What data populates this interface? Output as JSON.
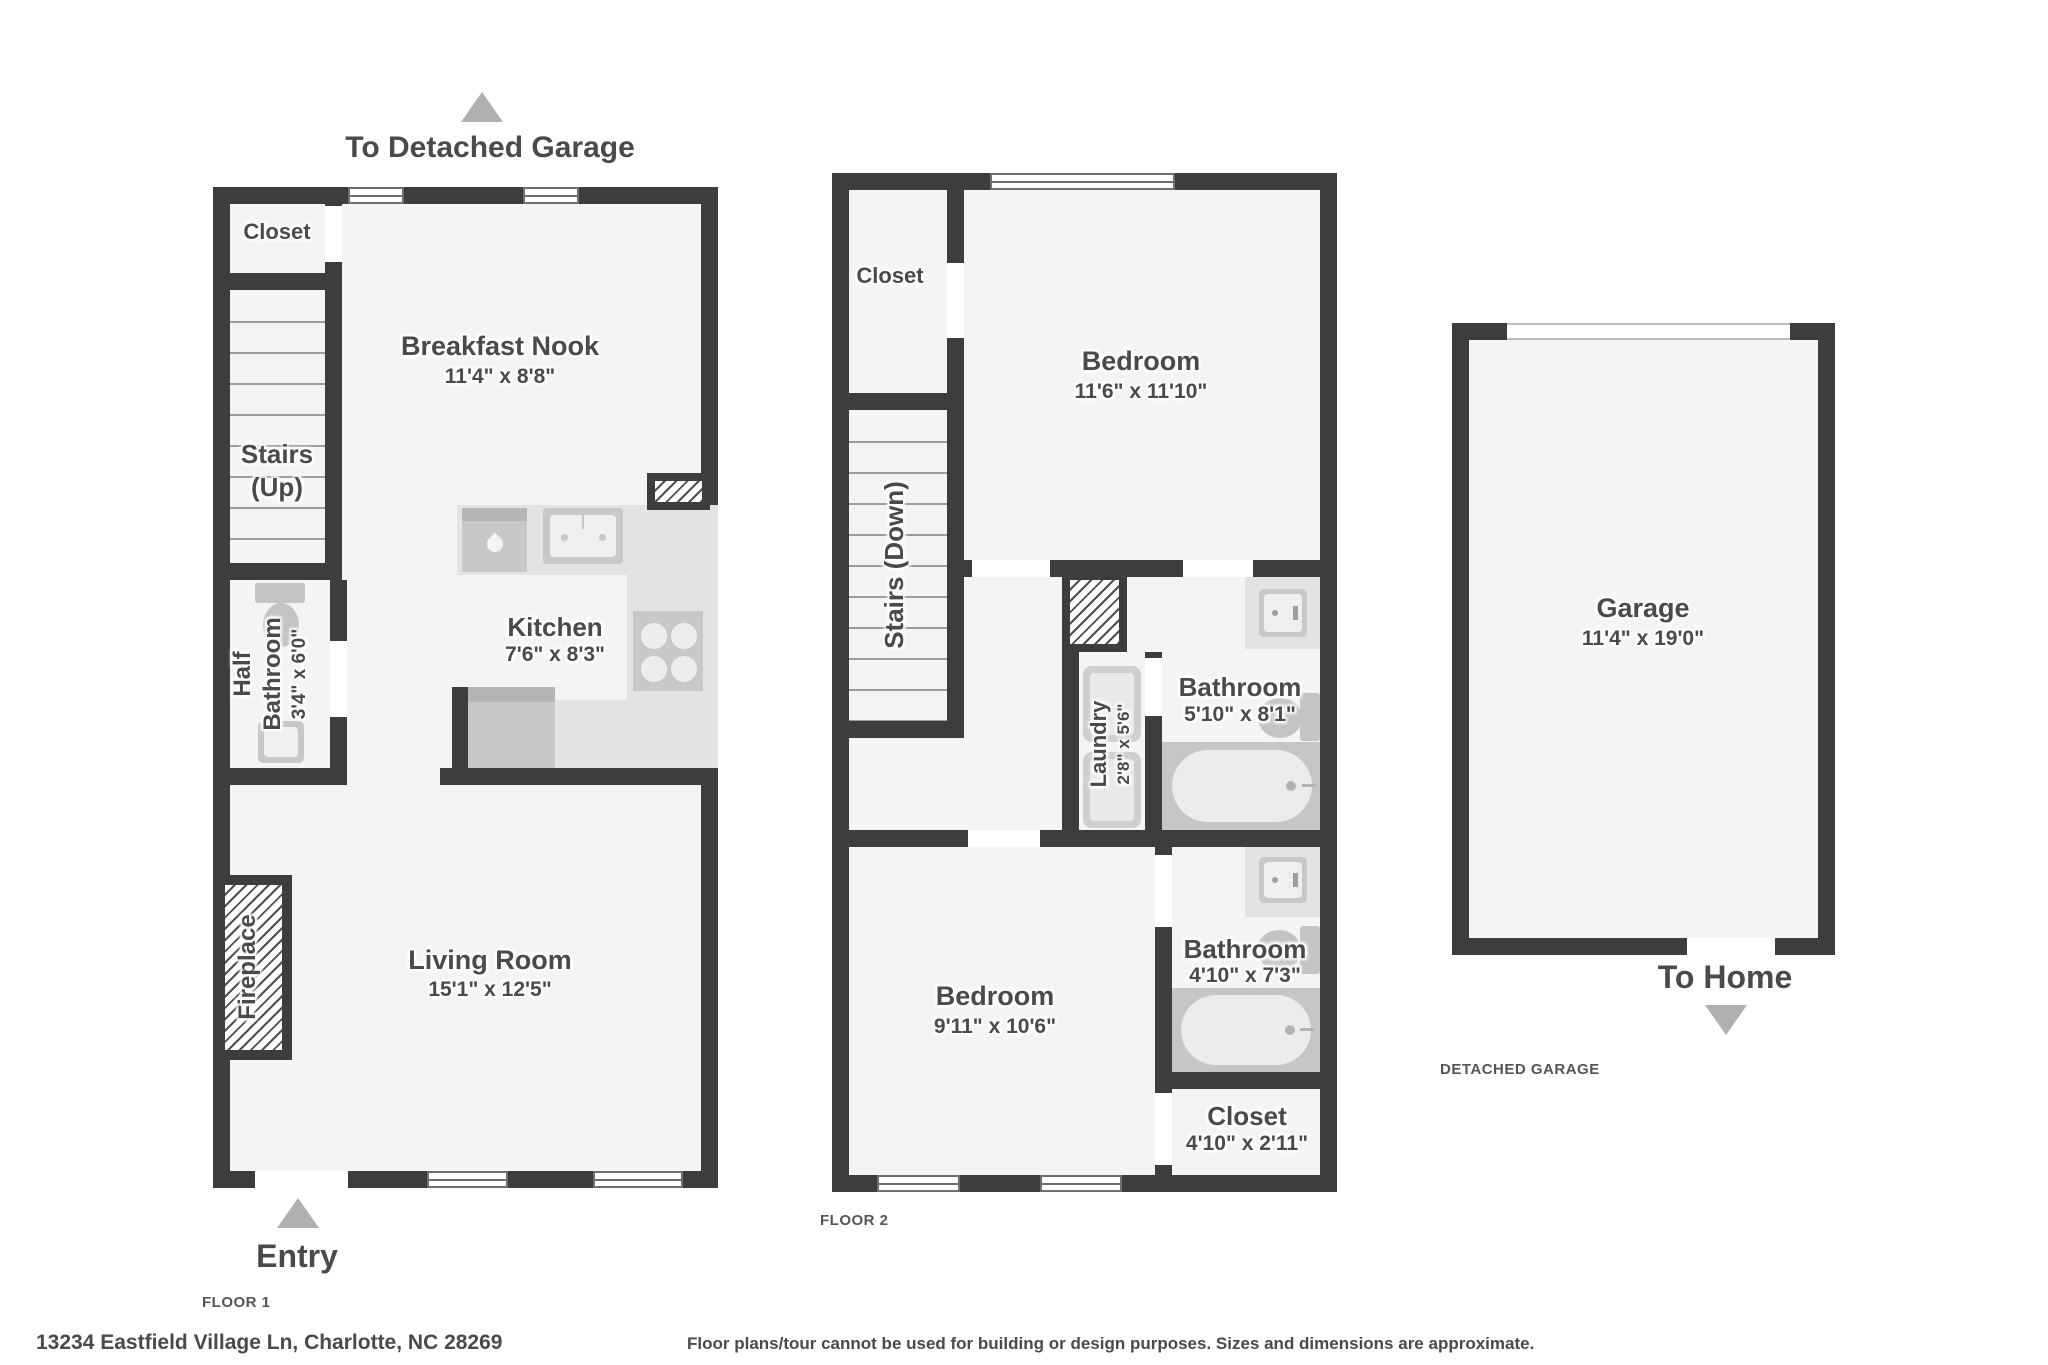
{
  "meta": {
    "address": "13234 Eastfield Village Ln, Charlotte, NC 28269",
    "disclaimer": "Floor plans/tour cannot be used for building or design purposes. Sizes and dimensions are approximate."
  },
  "floor1": {
    "floor_label": "FLOOR 1",
    "to_detached_garage": "To Detached Garage",
    "entry": "Entry",
    "closet": {
      "name": "Closet"
    },
    "breakfast_nook": {
      "name": "Breakfast Nook",
      "dims": "11'4\" x 8'8\""
    },
    "stairs": {
      "name": "Stairs",
      "direction": "(Up)"
    },
    "half_bathroom": {
      "name": "Half Bathroom",
      "dims": "3'4\" x 6'0\""
    },
    "kitchen": {
      "name": "Kitchen",
      "dims": "7'6\" x 8'3\""
    },
    "living_room": {
      "name": "Living Room",
      "dims": "15'1\" x 12'5\""
    },
    "fireplace": {
      "name": "Fireplace"
    }
  },
  "floor2": {
    "floor_label": "FLOOR 2",
    "closet_top": {
      "name": "Closet"
    },
    "stairs": {
      "name": "Stairs (Down)"
    },
    "bedroom_top": {
      "name": "Bedroom",
      "dims": "11'6\" x 11'10\""
    },
    "laundry": {
      "name": "Laundry",
      "dims": "2'8\" x 5'6\""
    },
    "bathroom_top": {
      "name": "Bathroom",
      "dims": "5'10\" x 8'1\""
    },
    "bedroom_bottom": {
      "name": "Bedroom",
      "dims": "9'11\" x 10'6\""
    },
    "bathroom_bottom": {
      "name": "Bathroom",
      "dims": "4'10\" x 7'3\""
    },
    "closet_bottom": {
      "name": "Closet",
      "dims": "4'10\" x 2'11\""
    }
  },
  "garage": {
    "label": "DETACHED GARAGE",
    "name": "Garage",
    "dims": "11'4\" x 19'0\"",
    "to_home": "To Home"
  },
  "colors": {
    "wall": "#3d3d3d",
    "room_fill": "#f4f4f4",
    "fixture": "#c8c8c8",
    "triangle": "#b0b0b0",
    "text": "#4a4a4a"
  }
}
